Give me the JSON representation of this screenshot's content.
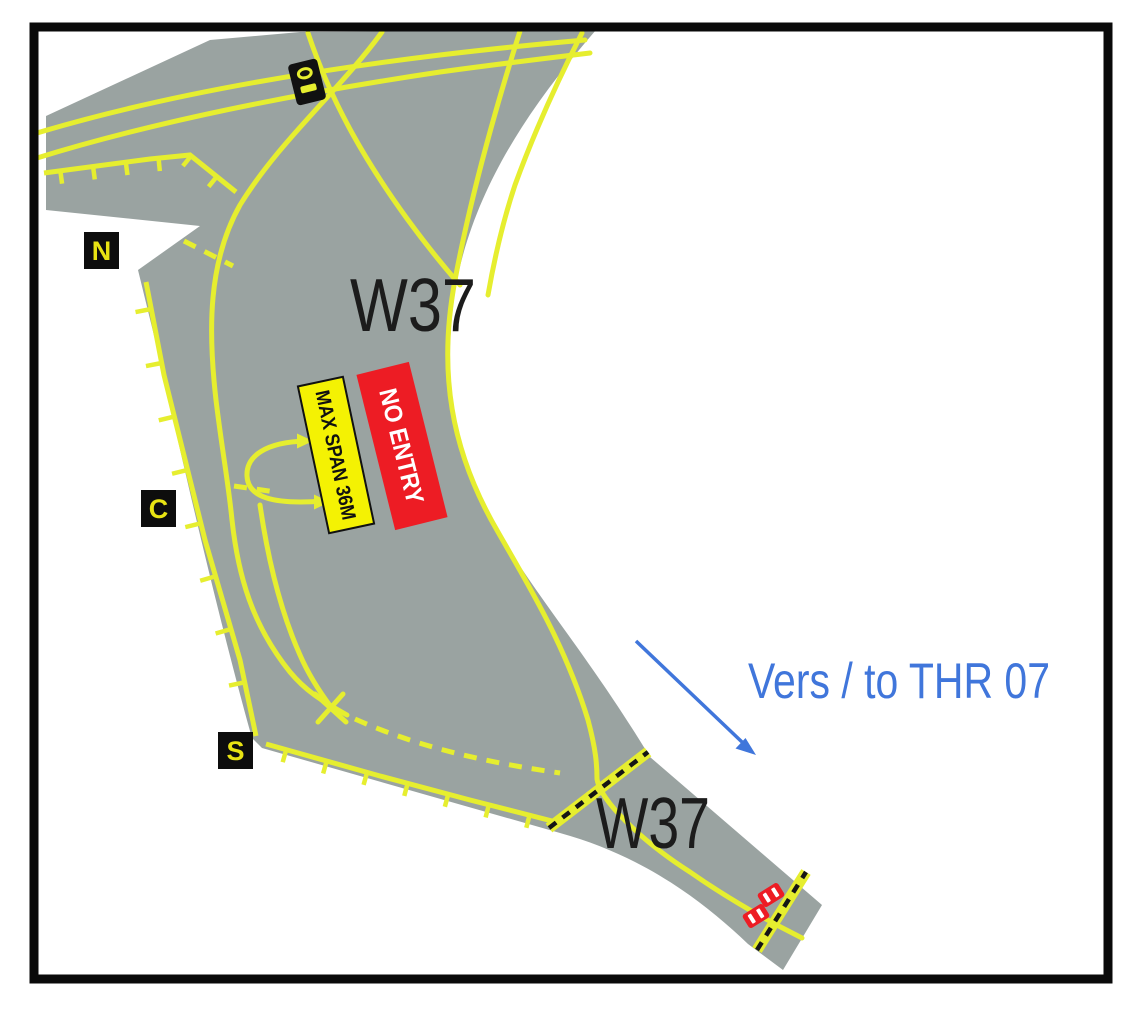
{
  "chart": {
    "title_taxiway": "W37",
    "labels": {
      "taxiway_top": "W37",
      "taxiway_bottom": "W37",
      "direction_note": "Vers / to THR 07"
    },
    "signs": {
      "max_span": "MAX SPAN 36M",
      "no_entry": "NO ENTRY"
    },
    "stand_markers": {
      "north": "N",
      "center": "C",
      "south": "S"
    },
    "colors": {
      "pavement": "#9aa3a1",
      "taxi_line": "#e6ee2f",
      "sign_yellow": "#f4f203",
      "sign_red": "#ed1c24",
      "annotation_blue": "#4076db",
      "label_black": "#1c1c1c",
      "marker_box": "#0d0d0d",
      "marker_letter": "#e8e313",
      "frame_black": "#0a0a0a"
    }
  }
}
